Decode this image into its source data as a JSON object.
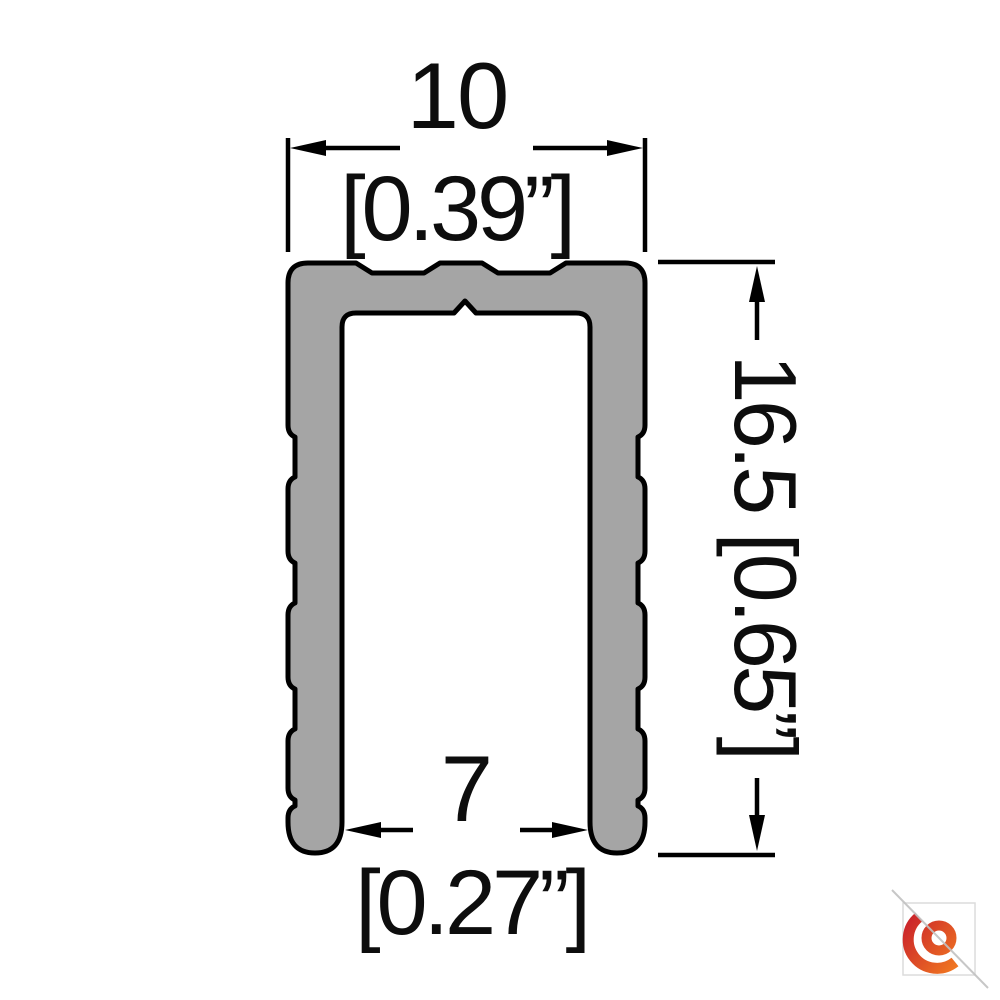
{
  "page": {
    "background": "#ffffff"
  },
  "profile": {
    "fill": "#a5a5a5",
    "outline": "#000000"
  },
  "dimensions": {
    "top": {
      "mm": "10",
      "inches": "[0.39”]"
    },
    "bottom": {
      "mm": "7",
      "inches": "[0.27”]"
    },
    "right": {
      "label": "16.5 [0.65”]"
    }
  },
  "logo": {
    "red": "#c9202b",
    "orange": "#f58220",
    "frame_gray": "#dcdcdc",
    "line_gray": "#c2c2c2"
  }
}
